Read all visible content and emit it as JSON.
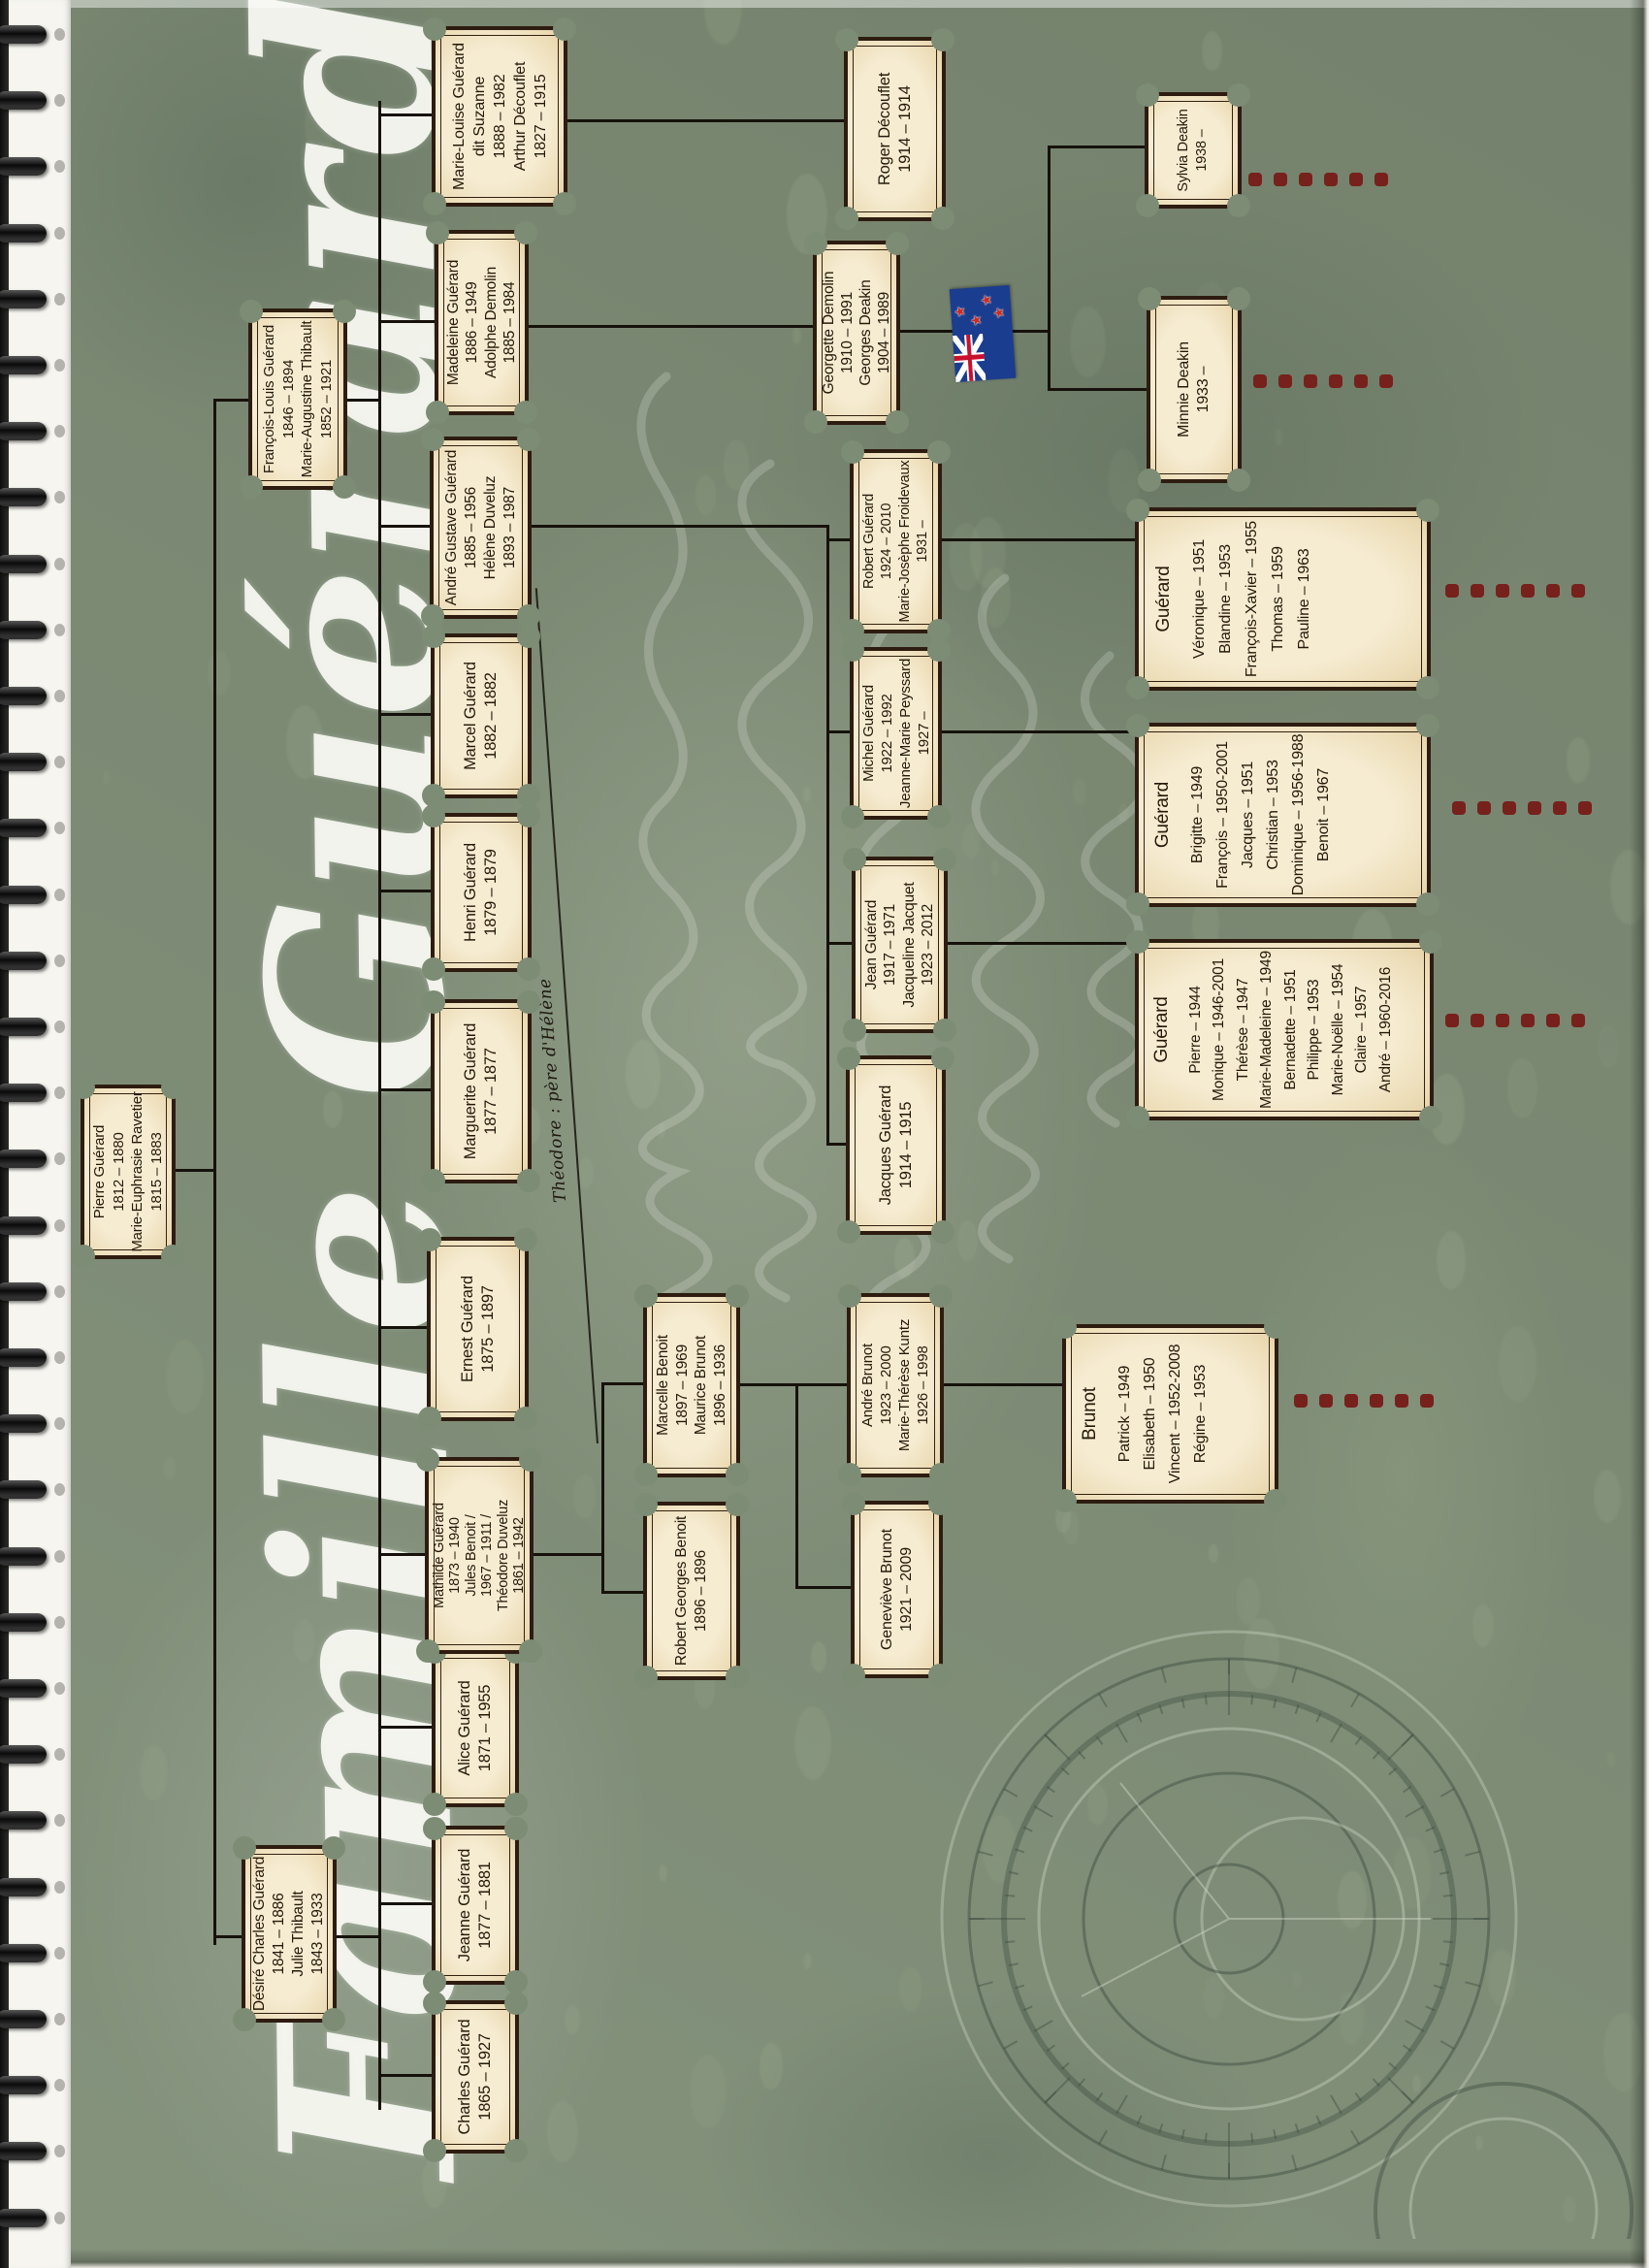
{
  "title": "Famille Guérard",
  "note_theodore": "Théodore : père d'Hélène",
  "people": [
    {
      "id": "pierre",
      "lines": [
        "Pierre Guérard",
        "1812 – 1880",
        "Marie-Euphrasie Ravetier",
        "1815 – 1883"
      ]
    },
    {
      "id": "desire",
      "lines": [
        "Désiré Charles Guérard",
        "1841 – 1886",
        "Julie Thibault",
        "1843 – 1933"
      ]
    },
    {
      "id": "francois",
      "lines": [
        "François-Louis Guérard",
        "1846 – 1894",
        "Marie-Augustine Thibault",
        "1852 – 1921"
      ]
    },
    {
      "id": "charles",
      "lines": [
        "Charles Guérard",
        "1865 – 1927"
      ]
    },
    {
      "id": "jeanne",
      "lines": [
        "Jeanne Guérard",
        "1877 – 1881"
      ]
    },
    {
      "id": "alice",
      "lines": [
        "Alice Guérard",
        "1871 – 1955"
      ]
    },
    {
      "id": "mathilde",
      "lines": [
        "Mathilde Guérard",
        "1873 – 1940",
        "Jules Benoit /",
        "1967 – 1911 /",
        "Théodore Duveluz",
        "1861 – 1942"
      ]
    },
    {
      "id": "ernest",
      "lines": [
        "Ernest Guérard",
        "1875 – 1897"
      ]
    },
    {
      "id": "marguerite",
      "lines": [
        "Marguerite Guérard",
        "1877 – 1877"
      ]
    },
    {
      "id": "henri",
      "lines": [
        "Henri Guérard",
        "1879 – 1879"
      ]
    },
    {
      "id": "marcel",
      "lines": [
        "Marcel Guérard",
        "1882 – 1882"
      ]
    },
    {
      "id": "andre_g",
      "lines": [
        "André Gustave Guérard",
        "1885 – 1956",
        "Hélène Duveluz",
        "1893 – 1987"
      ]
    },
    {
      "id": "madeleine",
      "lines": [
        "Madeleine Guérard",
        "1886 – 1949",
        "Adolphe Demolin",
        "1885 – 1984"
      ]
    },
    {
      "id": "marielouise",
      "lines": [
        "Marie-Louise Guérard",
        "dit Suzanne",
        "1888 – 1982",
        "Arthur Découflet",
        "1827 – 1915"
      ]
    },
    {
      "id": "robertg",
      "lines": [
        "Robert Guérard",
        "1924 – 2010",
        "Marie-Josèphe Froidevaux",
        "1931 –"
      ]
    },
    {
      "id": "michel",
      "lines": [
        "Michel Guérard",
        "1922 – 1992",
        "Jeanne-Marie Peyssard",
        "1927 –"
      ]
    },
    {
      "id": "jean",
      "lines": [
        "Jean Guérard",
        "1917 – 1971",
        "Jacqueline Jacquet",
        "1923 – 2012"
      ]
    },
    {
      "id": "jacques",
      "lines": [
        "Jacques Guérard",
        "1914 – 1915"
      ]
    },
    {
      "id": "georgette",
      "lines": [
        "Georgette Demolin",
        "1910 – 1991",
        "Georges Deakin",
        "1904 – 1989"
      ]
    },
    {
      "id": "roger",
      "lines": [
        "Roger Découflet",
        "1914 – 1914"
      ]
    },
    {
      "id": "marcelle",
      "lines": [
        "Marcelle Benoit",
        "1897 – 1969",
        "Maurice Brunot",
        "1896 – 1936"
      ]
    },
    {
      "id": "robertb",
      "lines": [
        "Robert Georges Benoit",
        "1896 – 1896"
      ]
    },
    {
      "id": "genevieve",
      "lines": [
        "Geneviève Brunot",
        "1921 – 2009"
      ]
    },
    {
      "id": "andreb",
      "lines": [
        "André Brunot",
        "1923 – 2000",
        "Marie-Thérèse Kuntz",
        "1926 – 1998"
      ]
    },
    {
      "id": "sylvia",
      "lines": [
        "Sylvia Deakin",
        "1938 –"
      ]
    },
    {
      "id": "minnie",
      "lines": [
        "Minnie Deakin",
        "1933 –"
      ]
    }
  ],
  "family_groups": [
    {
      "id": "kids1",
      "surname": "Guérard",
      "children": [
        "Véronique – 1951",
        "Blandine – 1953",
        "François-Xavier – 1955",
        "Thomas – 1959",
        "Pauline – 1963"
      ]
    },
    {
      "id": "kids2",
      "surname": "Guérard",
      "children": [
        "Brigitte – 1949",
        "François – 1950-2001",
        "Jacques – 1951",
        "Christian – 1953",
        "Dominique – 1956-1988",
        "Benoit – 1967"
      ]
    },
    {
      "id": "kids3",
      "surname": "Guérard",
      "children": [
        "Pierre – 1944",
        "Monique – 1946-2001",
        "Thérèse – 1947",
        "Marie-Madeleine – 1949",
        "Bernadette – 1951",
        "Philippe – 1953",
        "Marie-Noëlle – 1954",
        "Claire – 1957",
        "André – 1960-2016"
      ]
    },
    {
      "id": "brunot",
      "surname": "Brunot",
      "children": [
        "Patrick – 1949",
        "Elisabeth – 1950",
        "Vincent – 1952-2008",
        "Régine – 1953"
      ]
    }
  ],
  "flag_icon": "new-zealand-flag",
  "colors": {
    "page_green": "#7e8d76",
    "parchment": "#f6ecd2",
    "box_border": "#2e1c10",
    "line": "#16120b",
    "dots_red": "#76211b",
    "title_white": "#f8f9f2",
    "flag_blue": "#1b3d8f"
  }
}
